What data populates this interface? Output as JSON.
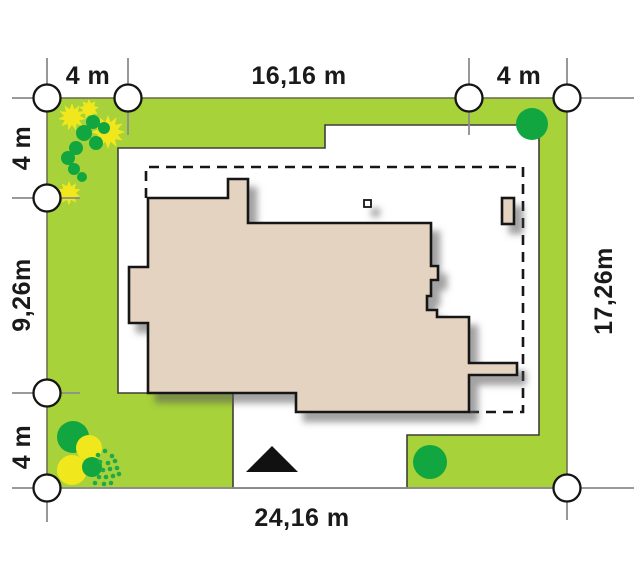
{
  "site_plan": {
    "dim_top": [
      "4 m",
      "16,16 m",
      "4 m"
    ],
    "dim_left": [
      "4 m",
      "9,26m",
      "4 m"
    ],
    "dim_right": "17,26m",
    "dim_bottom": "24,16 m",
    "colors": {
      "lawn": "#a7d239",
      "tree_green": "#12a640",
      "bush_yellow": "#f0e81c",
      "house_fill": "#e5d3c1",
      "outline": "#141414",
      "dim_line": "#8c8c8c"
    }
  }
}
